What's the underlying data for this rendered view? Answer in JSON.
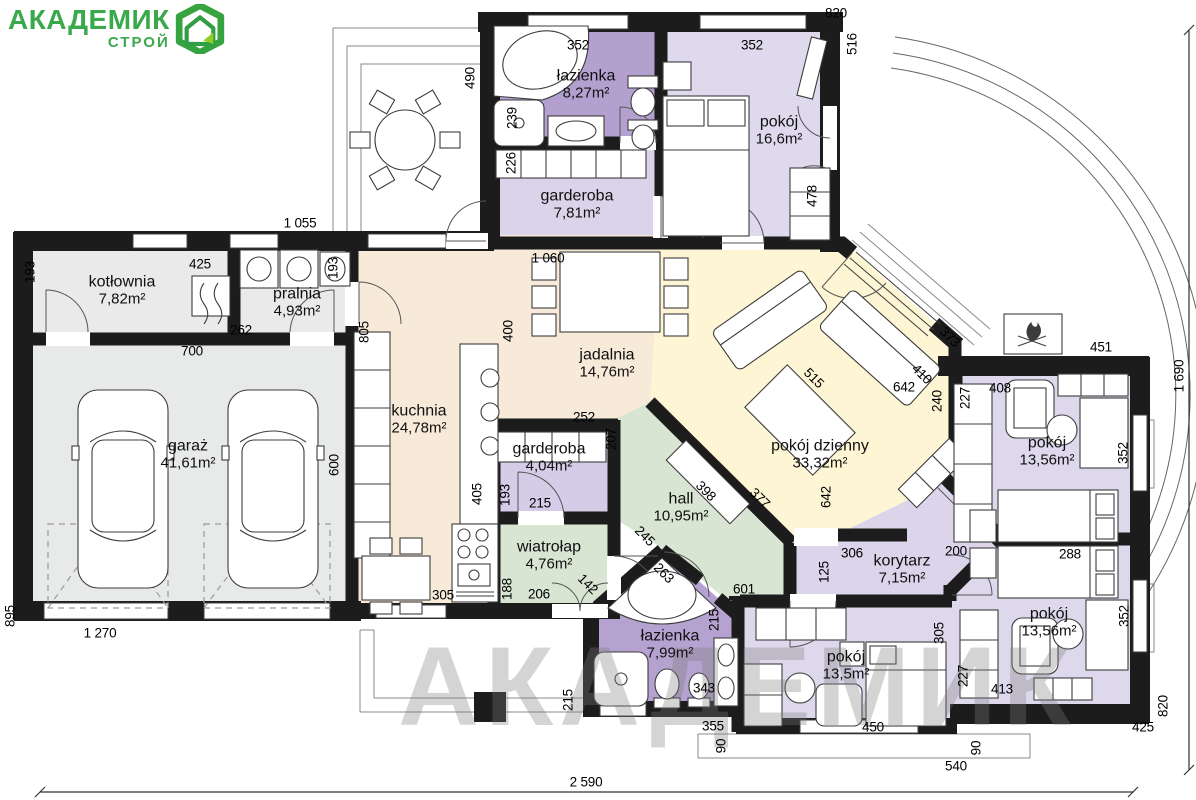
{
  "logo": {
    "title": "АКАДЕМИК",
    "subtitle": "СТРОЙ",
    "accent": "#3aa94c",
    "accent2": "#8fce2a"
  },
  "watermark": "АКАДЕМИК",
  "plan": {
    "colors": {
      "wall": "#1c1c1c",
      "bathroom_purple": "#b3a0ce",
      "room_purple": "#ddd7ec",
      "closet_purple": "#d5cde7",
      "utility_gray": "#e9eae9",
      "kitchen_peach": "#f8ead9",
      "living_yellow": "#fdf5d3",
      "hall_green": "#d7e5d2"
    },
    "rooms": [
      {
        "name": "kotłownia",
        "area": "7,82m²",
        "x": 122,
        "y": 291
      },
      {
        "name": "pralnia",
        "area": "4,93m²",
        "x": 297,
        "y": 303
      },
      {
        "name": "garaż",
        "area": "41,61m²",
        "x": 188,
        "y": 455
      },
      {
        "name": "kuchnia",
        "area": "24,78m²",
        "x": 419,
        "y": 420
      },
      {
        "name": "jadalnia",
        "area": "14,76m²",
        "x": 607,
        "y": 364
      },
      {
        "name": "garderoba",
        "area": "7,81m²",
        "x": 577,
        "y": 205
      },
      {
        "name": "łazienka",
        "area": "8,27m²",
        "x": 586,
        "y": 85
      },
      {
        "name": "pokój",
        "area": "16,6m²",
        "x": 779,
        "y": 131
      },
      {
        "name": "garderoba",
        "area": "4,04m²",
        "x": 549,
        "y": 458
      },
      {
        "name": "hall",
        "area": "10,95m²",
        "x": 681,
        "y": 508
      },
      {
        "name": "wiatrołap",
        "area": "4,76m²",
        "x": 549,
        "y": 556
      },
      {
        "name": "pokój dzienny",
        "area": "33,32m²",
        "x": 820,
        "y": 455
      },
      {
        "name": "korytarz",
        "area": "7,15m²",
        "x": 902,
        "y": 570
      },
      {
        "name": "łazienka",
        "area": "7,99m²",
        "x": 670,
        "y": 645
      },
      {
        "name": "pokój",
        "area": "13,5m²",
        "x": 846,
        "y": 666
      },
      {
        "name": "pokój",
        "area": "13,56m²",
        "x": 1047,
        "y": 452
      },
      {
        "name": "pokój",
        "area": "13,56m²",
        "x": 1049,
        "y": 623
      }
    ],
    "dimensions": [
      {
        "v": "820",
        "x": 836,
        "y": 13,
        "r": 0
      },
      {
        "v": "516",
        "x": 852,
        "y": 44,
        "r": -90
      },
      {
        "v": "352",
        "x": 578,
        "y": 45,
        "r": 0
      },
      {
        "v": "352",
        "x": 752,
        "y": 45,
        "r": 0
      },
      {
        "v": "490",
        "x": 470,
        "y": 78,
        "r": -90
      },
      {
        "v": "239",
        "x": 512,
        "y": 118,
        "r": -90
      },
      {
        "v": "226",
        "x": 511,
        "y": 163,
        "r": -90
      },
      {
        "v": "478",
        "x": 812,
        "y": 196,
        "r": -90
      },
      {
        "v": "1 055",
        "x": 300,
        "y": 223,
        "r": 0
      },
      {
        "v": "1 060",
        "x": 548,
        "y": 258,
        "r": 0
      },
      {
        "v": "193",
        "x": 30,
        "y": 272,
        "r": -90
      },
      {
        "v": "425",
        "x": 200,
        "y": 264,
        "r": 0
      },
      {
        "v": "262",
        "x": 241,
        "y": 330,
        "r": 0
      },
      {
        "v": "193",
        "x": 333,
        "y": 268,
        "r": -90
      },
      {
        "v": "700",
        "x": 192,
        "y": 351,
        "r": 0
      },
      {
        "v": "805",
        "x": 364,
        "y": 332,
        "r": -90
      },
      {
        "v": "400",
        "x": 508,
        "y": 331,
        "r": -90
      },
      {
        "v": "600",
        "x": 334,
        "y": 465,
        "r": -90
      },
      {
        "v": "895",
        "x": 10,
        "y": 616,
        "r": -90
      },
      {
        "v": "1 270",
        "x": 100,
        "y": 633,
        "r": 0
      },
      {
        "v": "305",
        "x": 443,
        "y": 595,
        "r": 0
      },
      {
        "v": "405",
        "x": 477,
        "y": 494,
        "r": -90
      },
      {
        "v": "188",
        "x": 507,
        "y": 589,
        "r": -90
      },
      {
        "v": "206",
        "x": 539,
        "y": 594,
        "r": 0
      },
      {
        "v": "215",
        "x": 540,
        "y": 503,
        "r": 0
      },
      {
        "v": "193",
        "x": 505,
        "y": 495,
        "r": -90
      },
      {
        "v": "252",
        "x": 584,
        "y": 417,
        "r": 0
      },
      {
        "v": "207",
        "x": 611,
        "y": 439,
        "r": -90
      },
      {
        "v": "142",
        "x": 588,
        "y": 584,
        "r": 45
      },
      {
        "v": "245",
        "x": 645,
        "y": 536,
        "r": 45
      },
      {
        "v": "263",
        "x": 664,
        "y": 573,
        "r": 45
      },
      {
        "v": "601",
        "x": 744,
        "y": 589,
        "r": 0
      },
      {
        "v": "398",
        "x": 706,
        "y": 491,
        "r": 45
      },
      {
        "v": "377",
        "x": 760,
        "y": 498,
        "r": 45
      },
      {
        "v": "373",
        "x": 950,
        "y": 337,
        "r": 45
      },
      {
        "v": "410",
        "x": 922,
        "y": 374,
        "r": 45
      },
      {
        "v": "240",
        "x": 937,
        "y": 401,
        "r": -90
      },
      {
        "v": "515",
        "x": 814,
        "y": 378,
        "r": 45
      },
      {
        "v": "642",
        "x": 904,
        "y": 387,
        "r": 0
      },
      {
        "v": "642",
        "x": 826,
        "y": 497,
        "r": -90
      },
      {
        "v": "451",
        "x": 1101,
        "y": 347,
        "r": 0
      },
      {
        "v": "1 690",
        "x": 1179,
        "y": 376,
        "r": -90
      },
      {
        "v": "408",
        "x": 1000,
        "y": 388,
        "r": 0
      },
      {
        "v": "227",
        "x": 965,
        "y": 398,
        "r": -90
      },
      {
        "v": "352",
        "x": 1123,
        "y": 453,
        "r": -90
      },
      {
        "v": "306",
        "x": 852,
        "y": 553,
        "r": 0
      },
      {
        "v": "200",
        "x": 956,
        "y": 551,
        "r": 0
      },
      {
        "v": "125",
        "x": 824,
        "y": 572,
        "r": -90
      },
      {
        "v": "288",
        "x": 1070,
        "y": 554,
        "r": 0
      },
      {
        "v": "352",
        "x": 1124,
        "y": 616,
        "r": -90
      },
      {
        "v": "305",
        "x": 939,
        "y": 633,
        "r": -90
      },
      {
        "v": "227",
        "x": 963,
        "y": 676,
        "r": -90
      },
      {
        "v": "413",
        "x": 1002,
        "y": 689,
        "r": 0
      },
      {
        "v": "450",
        "x": 873,
        "y": 727,
        "r": 0
      },
      {
        "v": "90",
        "x": 721,
        "y": 746,
        "r": -90
      },
      {
        "v": "90",
        "x": 976,
        "y": 748,
        "r": -90
      },
      {
        "v": "540",
        "x": 956,
        "y": 766,
        "r": 0
      },
      {
        "v": "425",
        "x": 1143,
        "y": 727,
        "r": 0
      },
      {
        "v": "820",
        "x": 1163,
        "y": 706,
        "r": -90
      },
      {
        "v": "355",
        "x": 713,
        "y": 726,
        "r": 0
      },
      {
        "v": "343",
        "x": 704,
        "y": 688,
        "r": 0
      },
      {
        "v": "215",
        "x": 714,
        "y": 620,
        "r": -90
      },
      {
        "v": "215",
        "x": 568,
        "y": 700,
        "r": -90
      },
      {
        "v": "2 590",
        "x": 586,
        "y": 782,
        "r": 0
      }
    ]
  }
}
